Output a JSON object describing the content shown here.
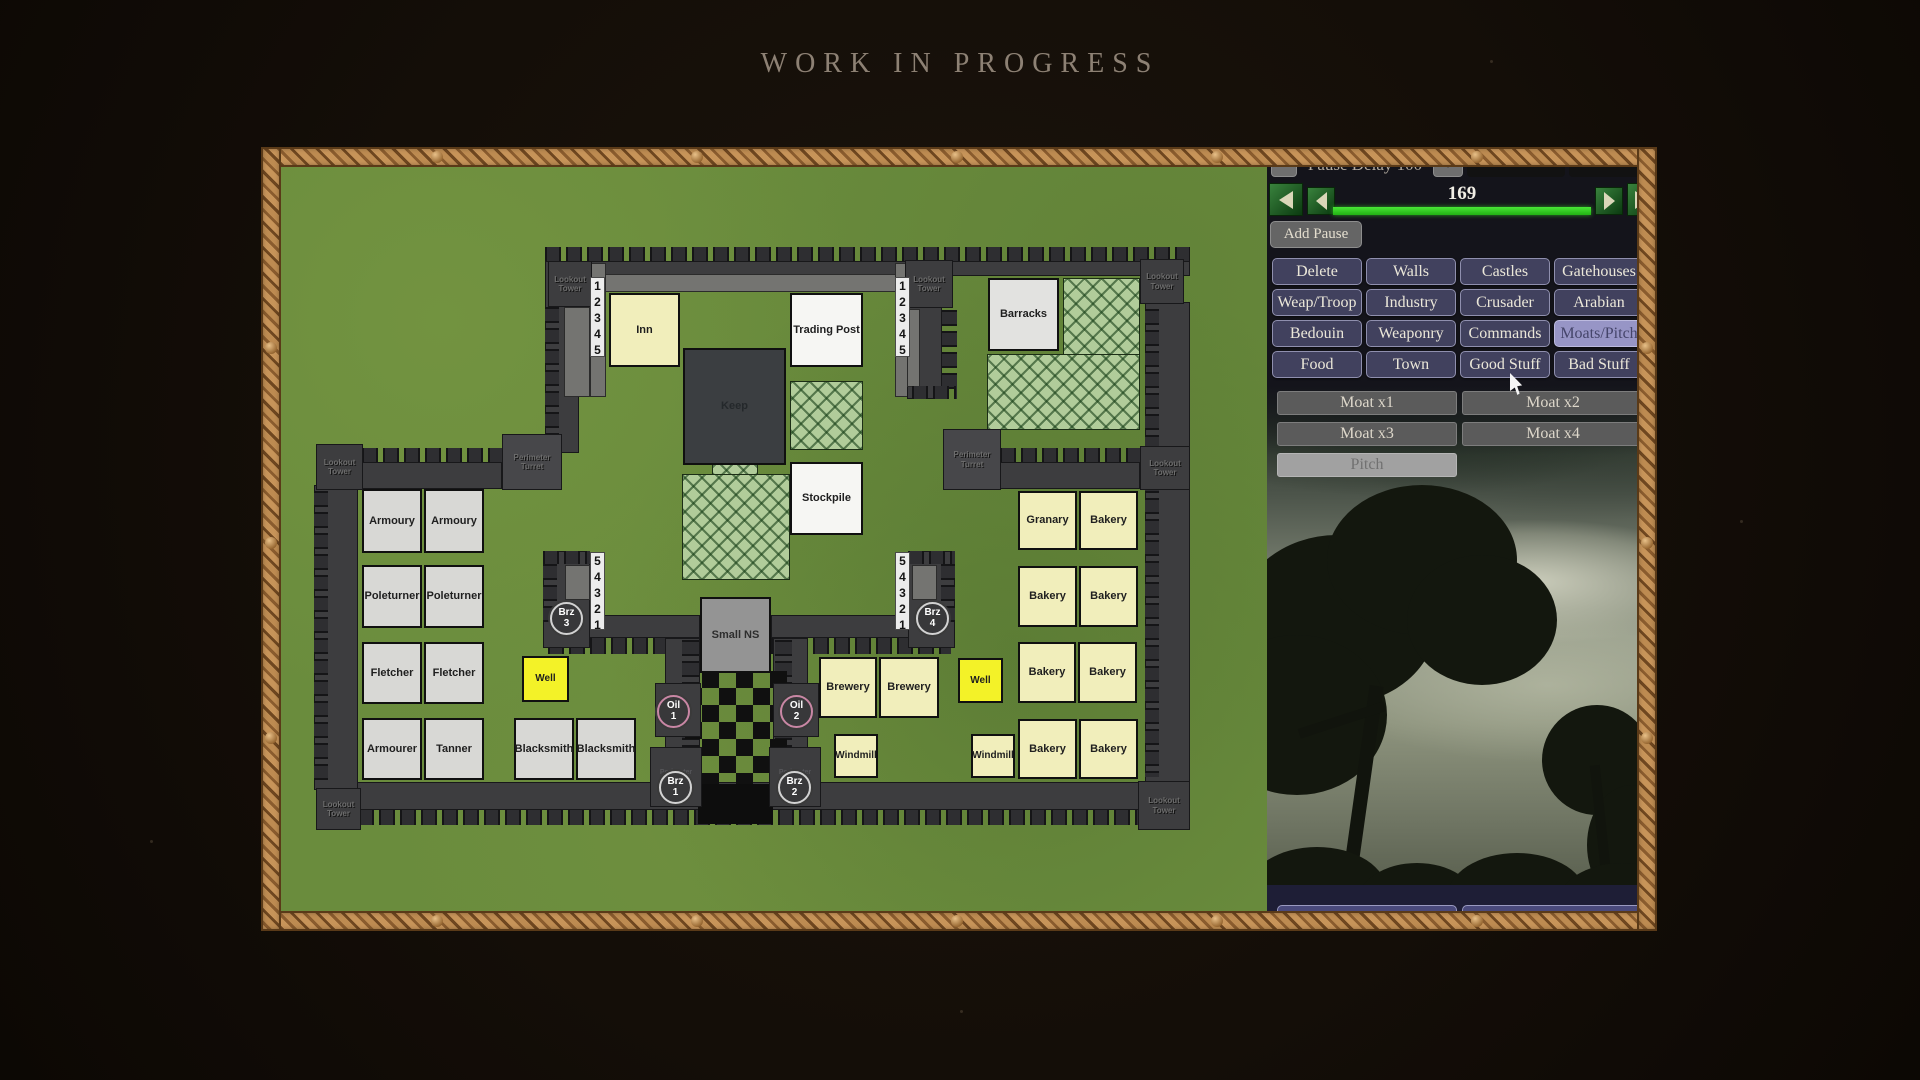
{
  "title": "WORK IN PROGRESS",
  "panel": {
    "pause_minus": "-",
    "pause_label": "Pause Delay 100",
    "pause_plus": "+",
    "zoom_button": "Zoom 5x",
    "scroll_button": "Scroll 2x",
    "counter": "169",
    "add_pause": "Add Pause",
    "progress_color": "#2fd121",
    "category_buttons": [
      {
        "label": "Delete",
        "selected": false
      },
      {
        "label": "Walls",
        "selected": false
      },
      {
        "label": "Castles",
        "selected": false
      },
      {
        "label": "Gatehouses",
        "selected": false
      },
      {
        "label": "Weap/Troop",
        "selected": false
      },
      {
        "label": "Industry",
        "selected": false
      },
      {
        "label": "Crusader",
        "selected": false
      },
      {
        "label": "Arabian",
        "selected": false
      },
      {
        "label": "Bedouin",
        "selected": false
      },
      {
        "label": "Weaponry",
        "selected": false
      },
      {
        "label": "Commands",
        "selected": false
      },
      {
        "label": "Moats/Pitch",
        "selected": true
      },
      {
        "label": "Food",
        "selected": false
      },
      {
        "label": "Town",
        "selected": false
      },
      {
        "label": "Good Stuff",
        "selected": false
      },
      {
        "label": "Bad Stuff",
        "selected": false
      }
    ],
    "moat_buttons": [
      "Moat x1",
      "Moat x2",
      "Moat x3",
      "Moat x4"
    ],
    "pitch_button": {
      "label": "Pitch",
      "selected": true
    },
    "save_button": "Save Village",
    "leave_button": "Leave Village"
  },
  "map": {
    "labels": {
      "lookout_tower": "Lookout Tower",
      "perimeter_turret": "Perimeter Turret"
    },
    "strips": {
      "asc": "12345",
      "desc": "54321"
    },
    "buildings": [
      {
        "label": "Inn"
      },
      {
        "label": "Trading Post"
      },
      {
        "label": "Barracks"
      },
      {
        "label": "Keep"
      },
      {
        "label": "Stockpile"
      },
      {
        "label": "Armoury"
      },
      {
        "label": "Armoury"
      },
      {
        "label": "Poleturner"
      },
      {
        "label": "Poleturner"
      },
      {
        "label": "Fletcher"
      },
      {
        "label": "Fletcher"
      },
      {
        "label": "Armourer"
      },
      {
        "label": "Tanner"
      },
      {
        "label": "Blacksmith"
      },
      {
        "label": "Blacksmith"
      },
      {
        "label": "Well"
      },
      {
        "label": "Well"
      },
      {
        "label": "Small NS"
      },
      {
        "label": "Brewery"
      },
      {
        "label": "Brewery"
      },
      {
        "label": "Windmill"
      },
      {
        "label": "Windmill"
      },
      {
        "label": "Granary"
      },
      {
        "label": "Bakery"
      },
      {
        "label": "Bakery"
      },
      {
        "label": "Bakery"
      },
      {
        "label": "Bakery"
      },
      {
        "label": "Bakery"
      },
      {
        "label": "Bakery"
      },
      {
        "label": "Bakery"
      }
    ],
    "markers": [
      {
        "name": "Brz",
        "num": "3"
      },
      {
        "name": "Brz",
        "num": "4"
      },
      {
        "name": "Oil",
        "num": "1"
      },
      {
        "name": "Oil",
        "num": "2"
      },
      {
        "name": "Brz",
        "num": "1"
      },
      {
        "name": "Brz",
        "num": "2"
      }
    ]
  }
}
